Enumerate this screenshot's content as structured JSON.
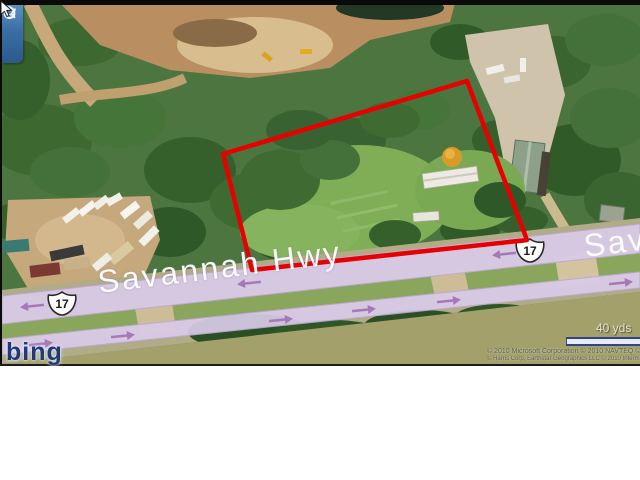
{
  "map": {
    "provider_logo": "bing",
    "road": {
      "name": "Savannah Hwy",
      "name_partial": "Sav",
      "shield_label": "17"
    },
    "scale": {
      "label": "40 yds"
    },
    "attribution": {
      "line1": "© 2010 Microsoft Corporation   © 2010 NAVTEQ   © AND",
      "line2": "© Harris Corp, Earthstar Geographics LLC  © 2010 Intermap Inc."
    },
    "nav_icons": [
      "magnifier-icon",
      "rotate-cw-icon",
      "rotate-ccw-icon"
    ],
    "colors": {
      "parcel_outline": "#e60000",
      "road_overlay": "#d9cbe8",
      "traffic_arrow": "#a778b8",
      "nav_panel": "#3a6ea5",
      "logo_navy": "#203a78"
    }
  }
}
